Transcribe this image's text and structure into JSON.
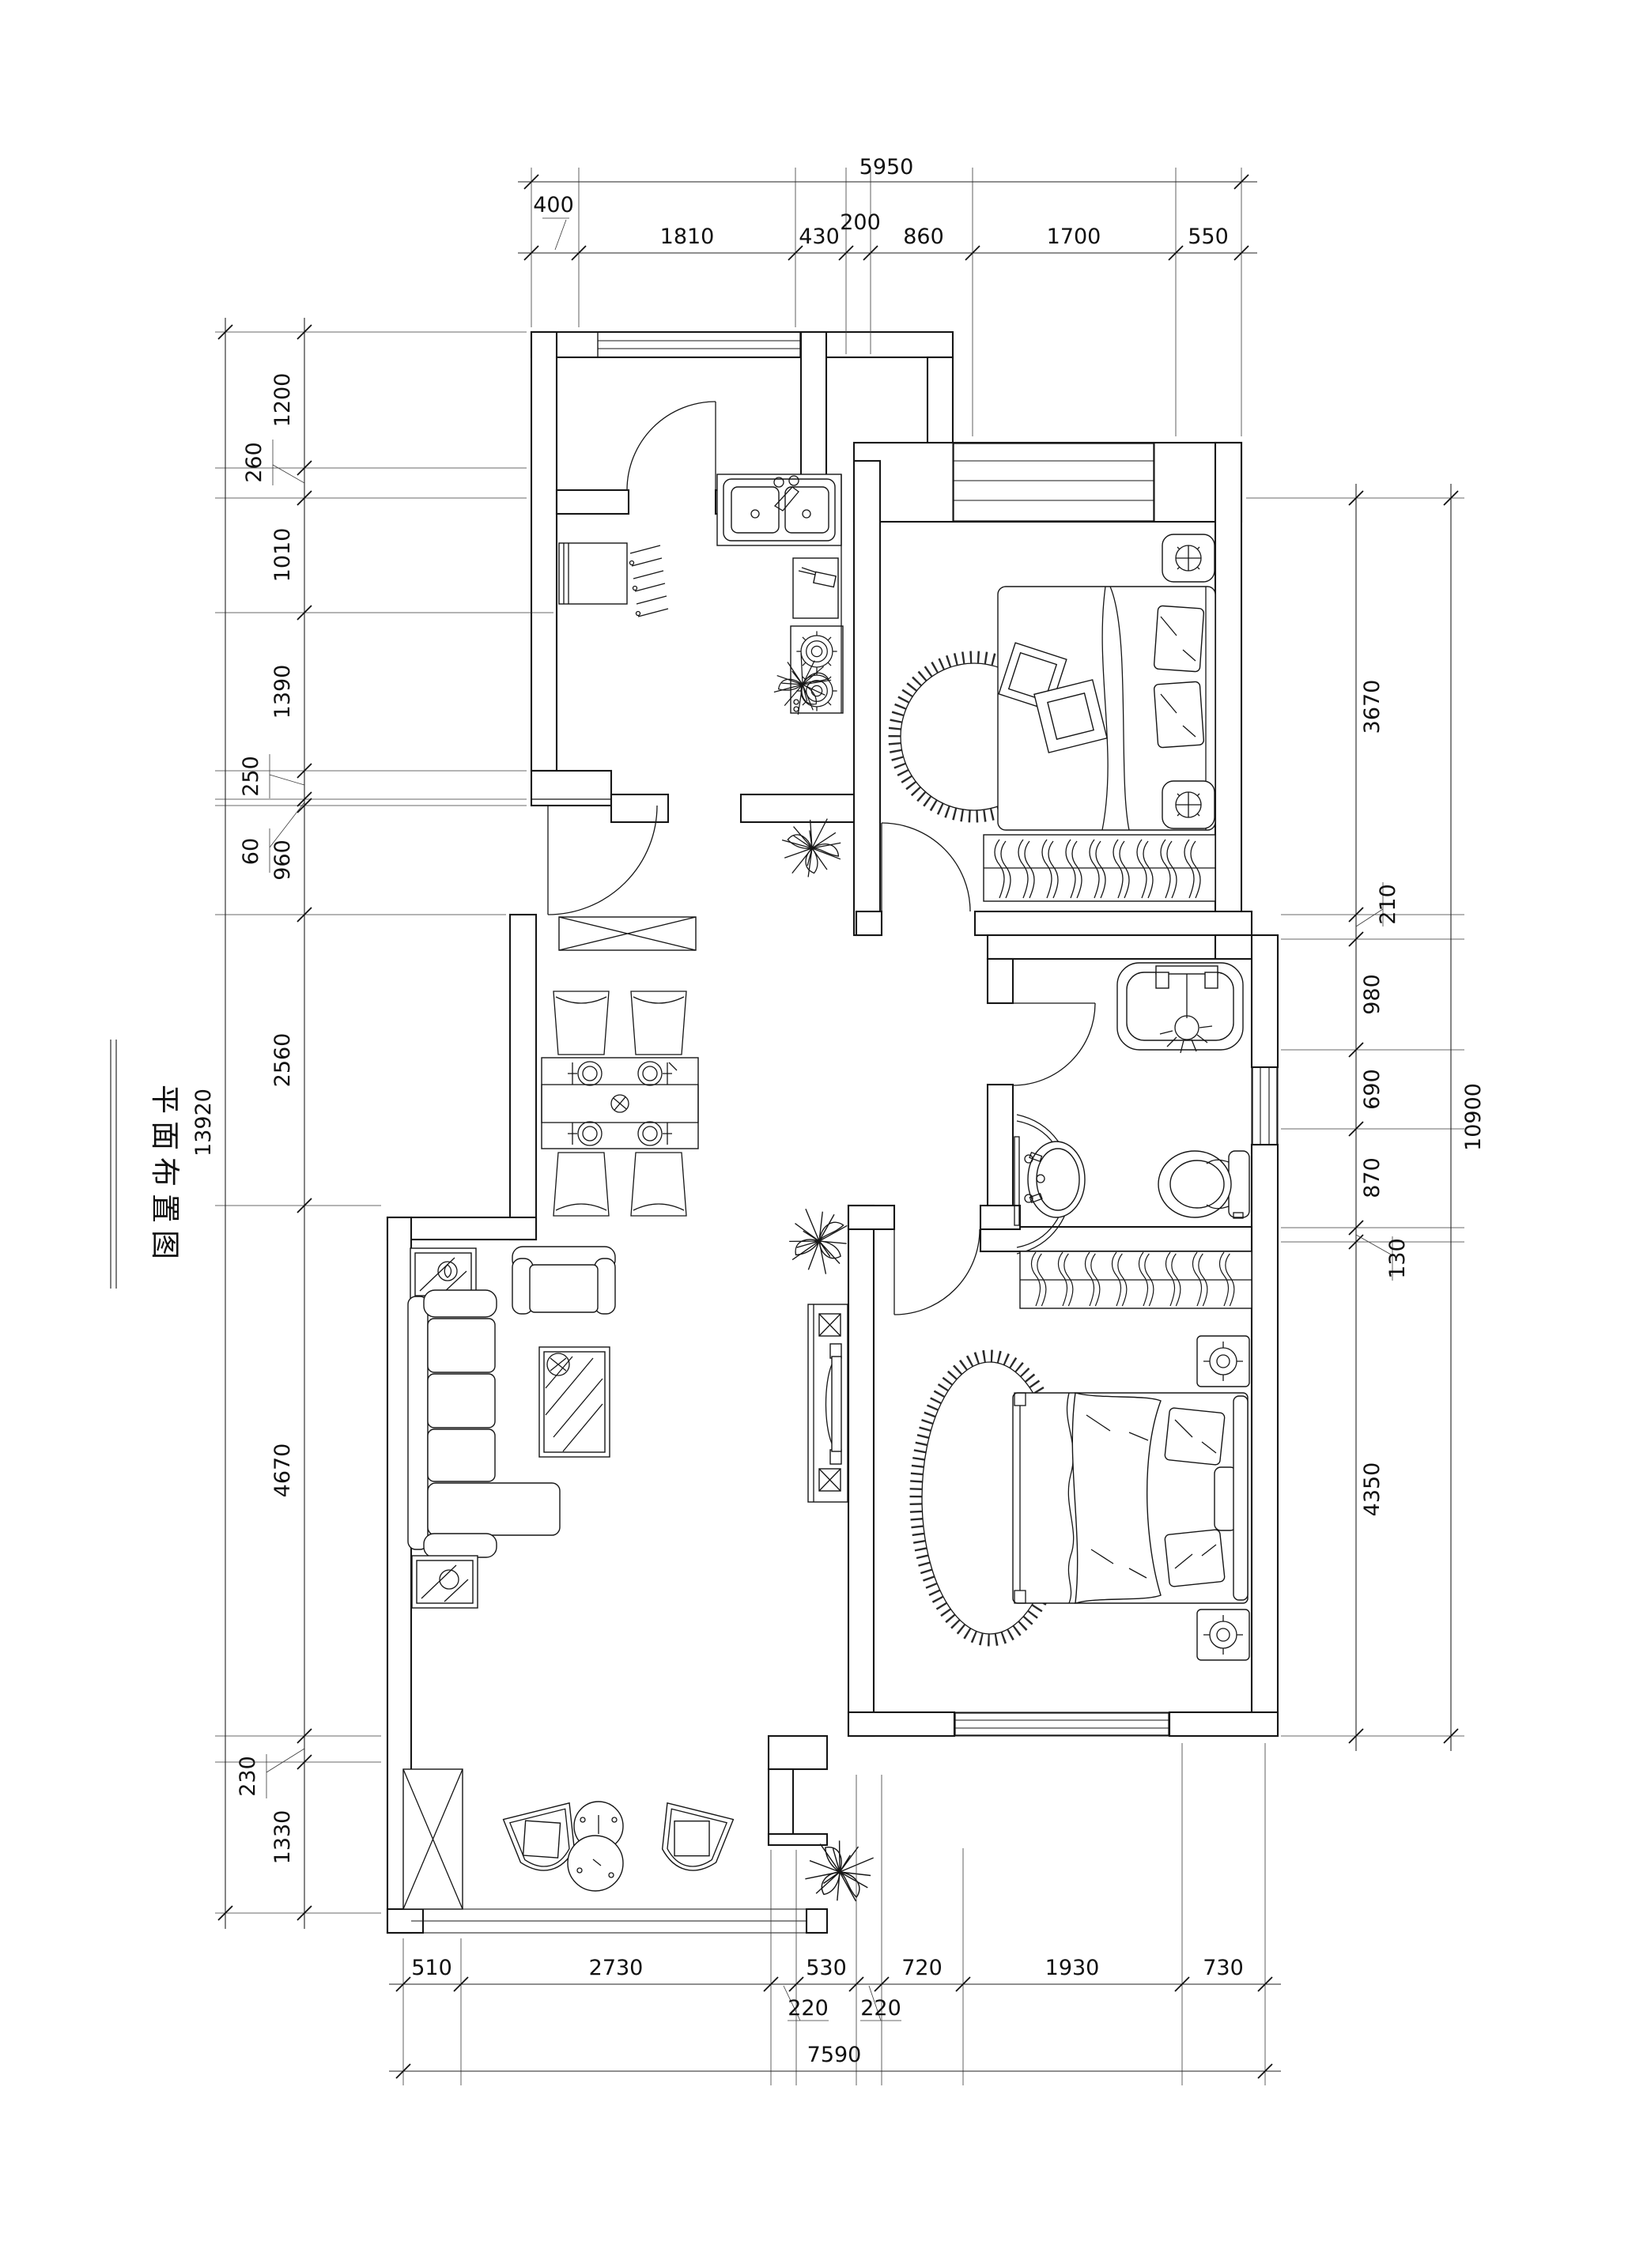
{
  "title": "平面布置图",
  "dims": {
    "top": {
      "total": "5950",
      "segments": [
        "400",
        "1810",
        "430",
        "200",
        "860",
        "1700",
        "550"
      ]
    },
    "bottom": {
      "total": "7590",
      "segments": [
        "510",
        "2730",
        "530",
        "720",
        "1930",
        "730"
      ],
      "offset_labels": [
        "220",
        "220"
      ]
    },
    "left": {
      "total": "13920",
      "segments": [
        "1200",
        "1010",
        "1390",
        "960",
        "2560",
        "4670",
        "1330"
      ],
      "offset_labels": [
        "260",
        "250",
        "60",
        "230"
      ]
    },
    "right": {
      "total": "10900",
      "segments": [
        "3670",
        "980",
        "690",
        "870",
        "4350"
      ],
      "offset_labels": [
        "210",
        "130"
      ]
    }
  },
  "furniture": [
    "entry-door",
    "interior-doors",
    "window",
    "double-sink",
    "cutting-board",
    "gas-stove",
    "refrigerator",
    "drying-rack",
    "shoe-cabinet",
    "dining-table",
    "dining-chair",
    "place-setting",
    "sofa",
    "armchair",
    "coffee-table",
    "side-table",
    "tv-cabinet",
    "tv",
    "double-bed",
    "pillow",
    "round-rug",
    "nightstand",
    "wardrobe-hanger",
    "shower",
    "vanity-basin",
    "toilet",
    "balcony-chair",
    "balcony-table",
    "plant",
    "structural-column"
  ]
}
